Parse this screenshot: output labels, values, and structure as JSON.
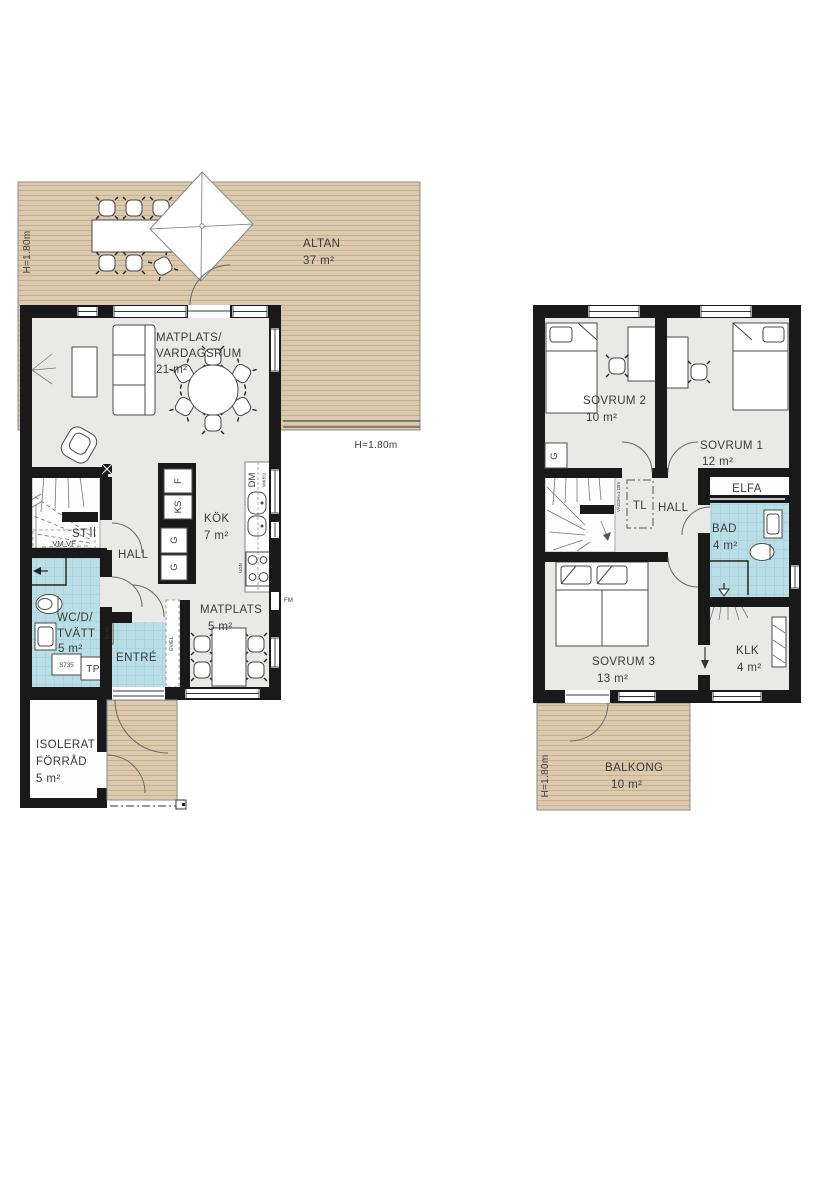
{
  "title": "floorplan-two-storey-house",
  "colors": {
    "wall": "#191919",
    "floor": "#e9e9e8",
    "wet_tile": "#badee6",
    "wood_deck": "#dccaae",
    "text": "#3a3a3a"
  },
  "f1": {
    "altan": {
      "label": "ALTAN",
      "area": "37 m²",
      "h_side": "H=1.80m",
      "h_bottom": "H=1.80m"
    },
    "living": {
      "l1": "MATPLATS/",
      "l2": "VARDAGSRUM",
      "area": "21 m²"
    },
    "kok": {
      "label": "KÖK",
      "area": "7 m²"
    },
    "matplats": {
      "label": "MATPLATS",
      "area": "5 m²"
    },
    "hall": "HALL",
    "st": "ST",
    "vmvf": "VM·VF",
    "wc": {
      "l1": "WC/D/",
      "l2": "TVÄTT",
      "area": "5 m²"
    },
    "entre": "ENTRÉ",
    "forrad": {
      "l1": "ISOLERAT",
      "l2": "FÖRRÅD",
      "area": "5 m²"
    },
    "units": {
      "f": "F",
      "ks": "KS",
      "g1": "G",
      "g2": "G",
      "dm": "DM",
      "mikro": "MIKRO",
      "ugn": "UGN",
      "s735": "S735",
      "tp": "TP",
      "fm": "FM",
      "elmc": "EL·MC",
      "gvel": "GV/EL"
    }
  },
  "f2": {
    "sovrum2": {
      "label": "SOVRUM 2",
      "area": "10 m²"
    },
    "sovrum1": {
      "label": "SOVRUM 1",
      "area": "12 m²"
    },
    "sovrum3": {
      "label": "SOVRUM 3",
      "area": "13 m²"
    },
    "hall": "HALL",
    "tl": "TL",
    "g": "G",
    "elfa": "ELFA",
    "vaggh": "VÄGGH=1.10m",
    "bad": {
      "label": "BAD",
      "area": "4 m²"
    },
    "klk": {
      "label": "KLK",
      "area": "4 m²"
    },
    "balkong": {
      "label": "BALKONG",
      "area": "10 m²",
      "h": "H=1.80m"
    }
  }
}
